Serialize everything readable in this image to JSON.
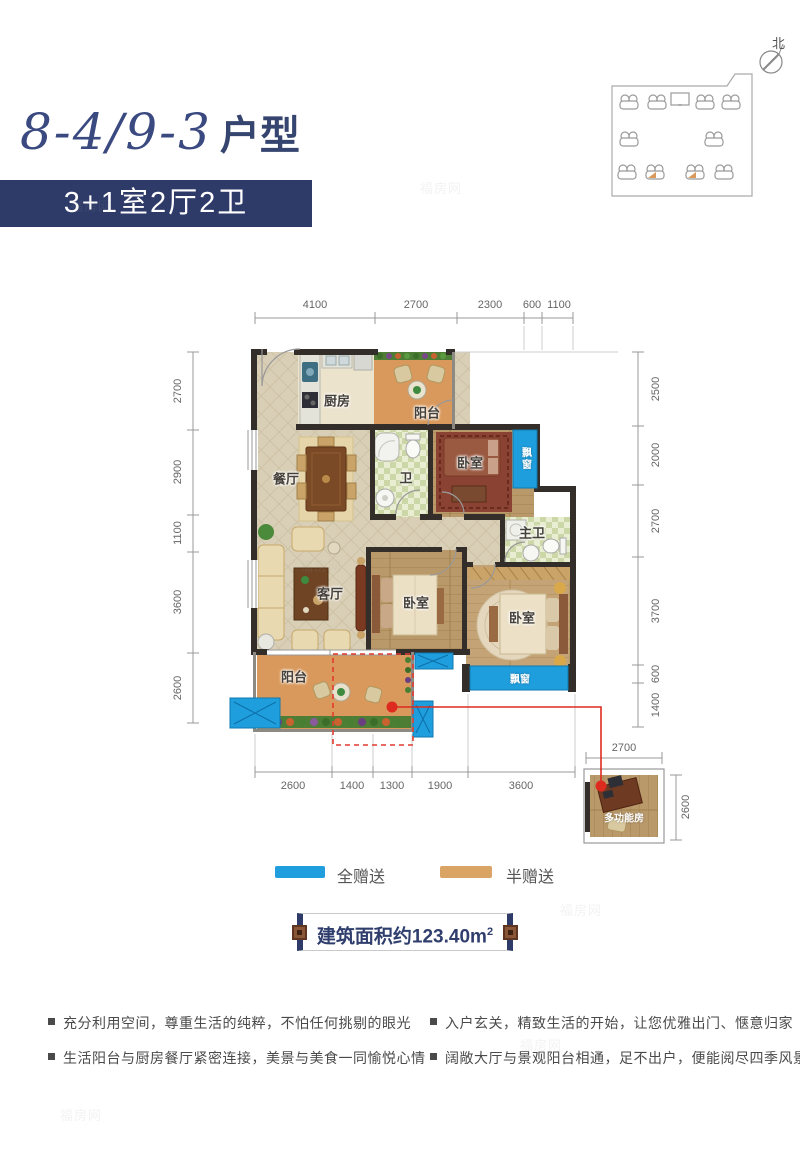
{
  "header": {
    "unit": "8-4/9-3",
    "type_suffix": "户型",
    "spec": "3+1室2厅2卫"
  },
  "site_plan": {
    "north": "北"
  },
  "plan": {
    "rooms": {
      "kitchen": "厨房",
      "balcony_top": "阳台",
      "dining": "餐厅",
      "bath": "卫",
      "bedroom_tr": "卧室",
      "bay_right": "飘窗",
      "master_bath": "主卫",
      "living": "客厅",
      "bedroom_mid": "卧室",
      "bedroom_br": "卧室",
      "bay_bottom": "飘窗",
      "balcony_bottom": "阳台",
      "multi": "多功能房"
    },
    "dims": {
      "top": [
        "4100",
        "2700",
        "2300",
        "600",
        "1100"
      ],
      "left": [
        "2700",
        "2900",
        "1100",
        "3600",
        "2600"
      ],
      "right": [
        "2500",
        "2000",
        "2700",
        "3700",
        "600",
        "1400"
      ],
      "bottom": [
        "2600",
        "1400",
        "1300",
        "1900",
        "3600"
      ],
      "multi": {
        "w": "2700",
        "h": "2600"
      }
    }
  },
  "legend": {
    "items": [
      {
        "label": "全赠送",
        "color": "#1f9ede"
      },
      {
        "label": "半赠送",
        "color": "#d9a464"
      }
    ]
  },
  "banner": {
    "area_text": "建筑面积约123.40m",
    "area_sup": "2"
  },
  "features": {
    "left": [
      "充分利用空间，尊重生活的纯粹，不怕任何挑剔的眼光",
      "生活阳台与厨房餐厅紧密连接，美景与美食一同愉悦心情"
    ],
    "right": [
      "入户玄关，精致生活的开始，让您优雅出门、惬意归家",
      "阔敞大厅与景观阳台相通，足不出户，便能阅尽四季风景"
    ]
  },
  "watermark": "福房网",
  "colors": {
    "navy": "#2e3b69",
    "title": "#3a4a80",
    "gift_full": "#1f9ede",
    "gift_half": "#d9a464",
    "red": "#dd2b20",
    "wall": "#332e29"
  }
}
